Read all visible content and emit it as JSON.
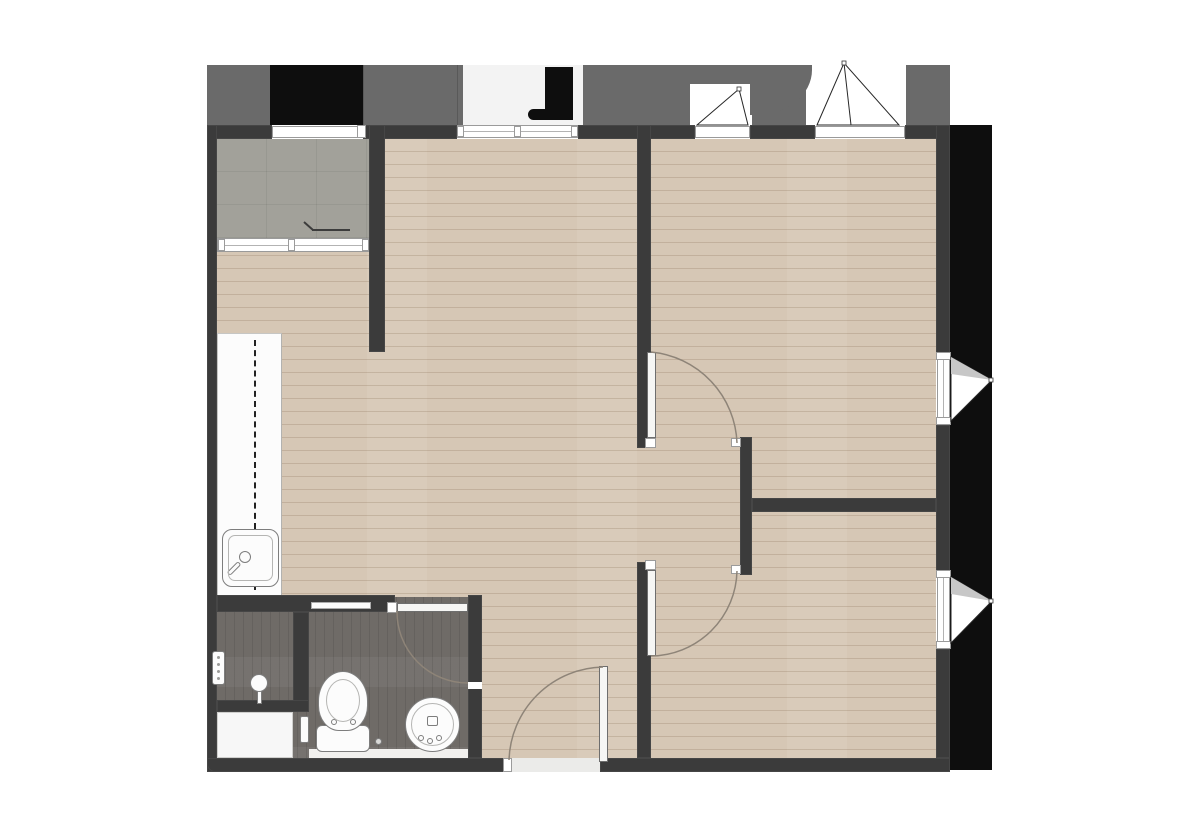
{
  "plan": {
    "type": "apartment-floor-plan",
    "rooms": [
      "balcony",
      "kitchen",
      "living-area",
      "bedroom-top-right",
      "bedroom-bottom-right",
      "bathroom-toilet-room",
      "shower-room",
      "hallway"
    ],
    "fixtures": [
      "kitchen-counter",
      "kitchen-sink",
      "counter-dashed-cabinet-line",
      "shower-head",
      "shower-control-panel",
      "bath-tray",
      "toilet",
      "round-basin",
      "floor-drain",
      "paper-holder",
      "wall-shelf"
    ],
    "doors": [
      "entrance-door",
      "bathroom-door",
      "bedroom-top-door",
      "bedroom-bottom-door",
      "balcony-sliding-door"
    ],
    "windows": [
      "balcony-window",
      "top-center-sliding-window",
      "top-casement-window-1",
      "top-casement-window-2",
      "right-casement-window-upper",
      "right-casement-window-lower"
    ]
  },
  "colors": {
    "background": "#ffffff",
    "exterior_band": "#6a6a6a",
    "exterior_black": "#0e0e0e",
    "alcove": "#f3f3f3",
    "wall": "#3b3b3b",
    "wood_floor": "#d6c7b5",
    "wood_plank_line": "rgba(122,96,70,0.22)",
    "balcony_floor": "#a2a19a",
    "balcony_grid": "rgba(0,0,0,0.06)",
    "bathroom_floor": "#6f6b67",
    "bathroom_streak": "rgba(0,0,0,0.09)",
    "fixture_fill": "#fcfcfc",
    "fixture_outline": "#7d7d7d",
    "window_fill": "#ffffff",
    "window_frame": "#9a9a9a",
    "door_leaf": "#f6f6f4",
    "door_outline": "#6e6e6e",
    "swing_arc": "#8e8478",
    "symbol_line": "#262626",
    "sash_gray": "#c7c7c7",
    "threshold": "#ebebe9",
    "curb": "#f1f0ee",
    "tray": "#f7f7f7",
    "counter_dash": "#222222"
  }
}
